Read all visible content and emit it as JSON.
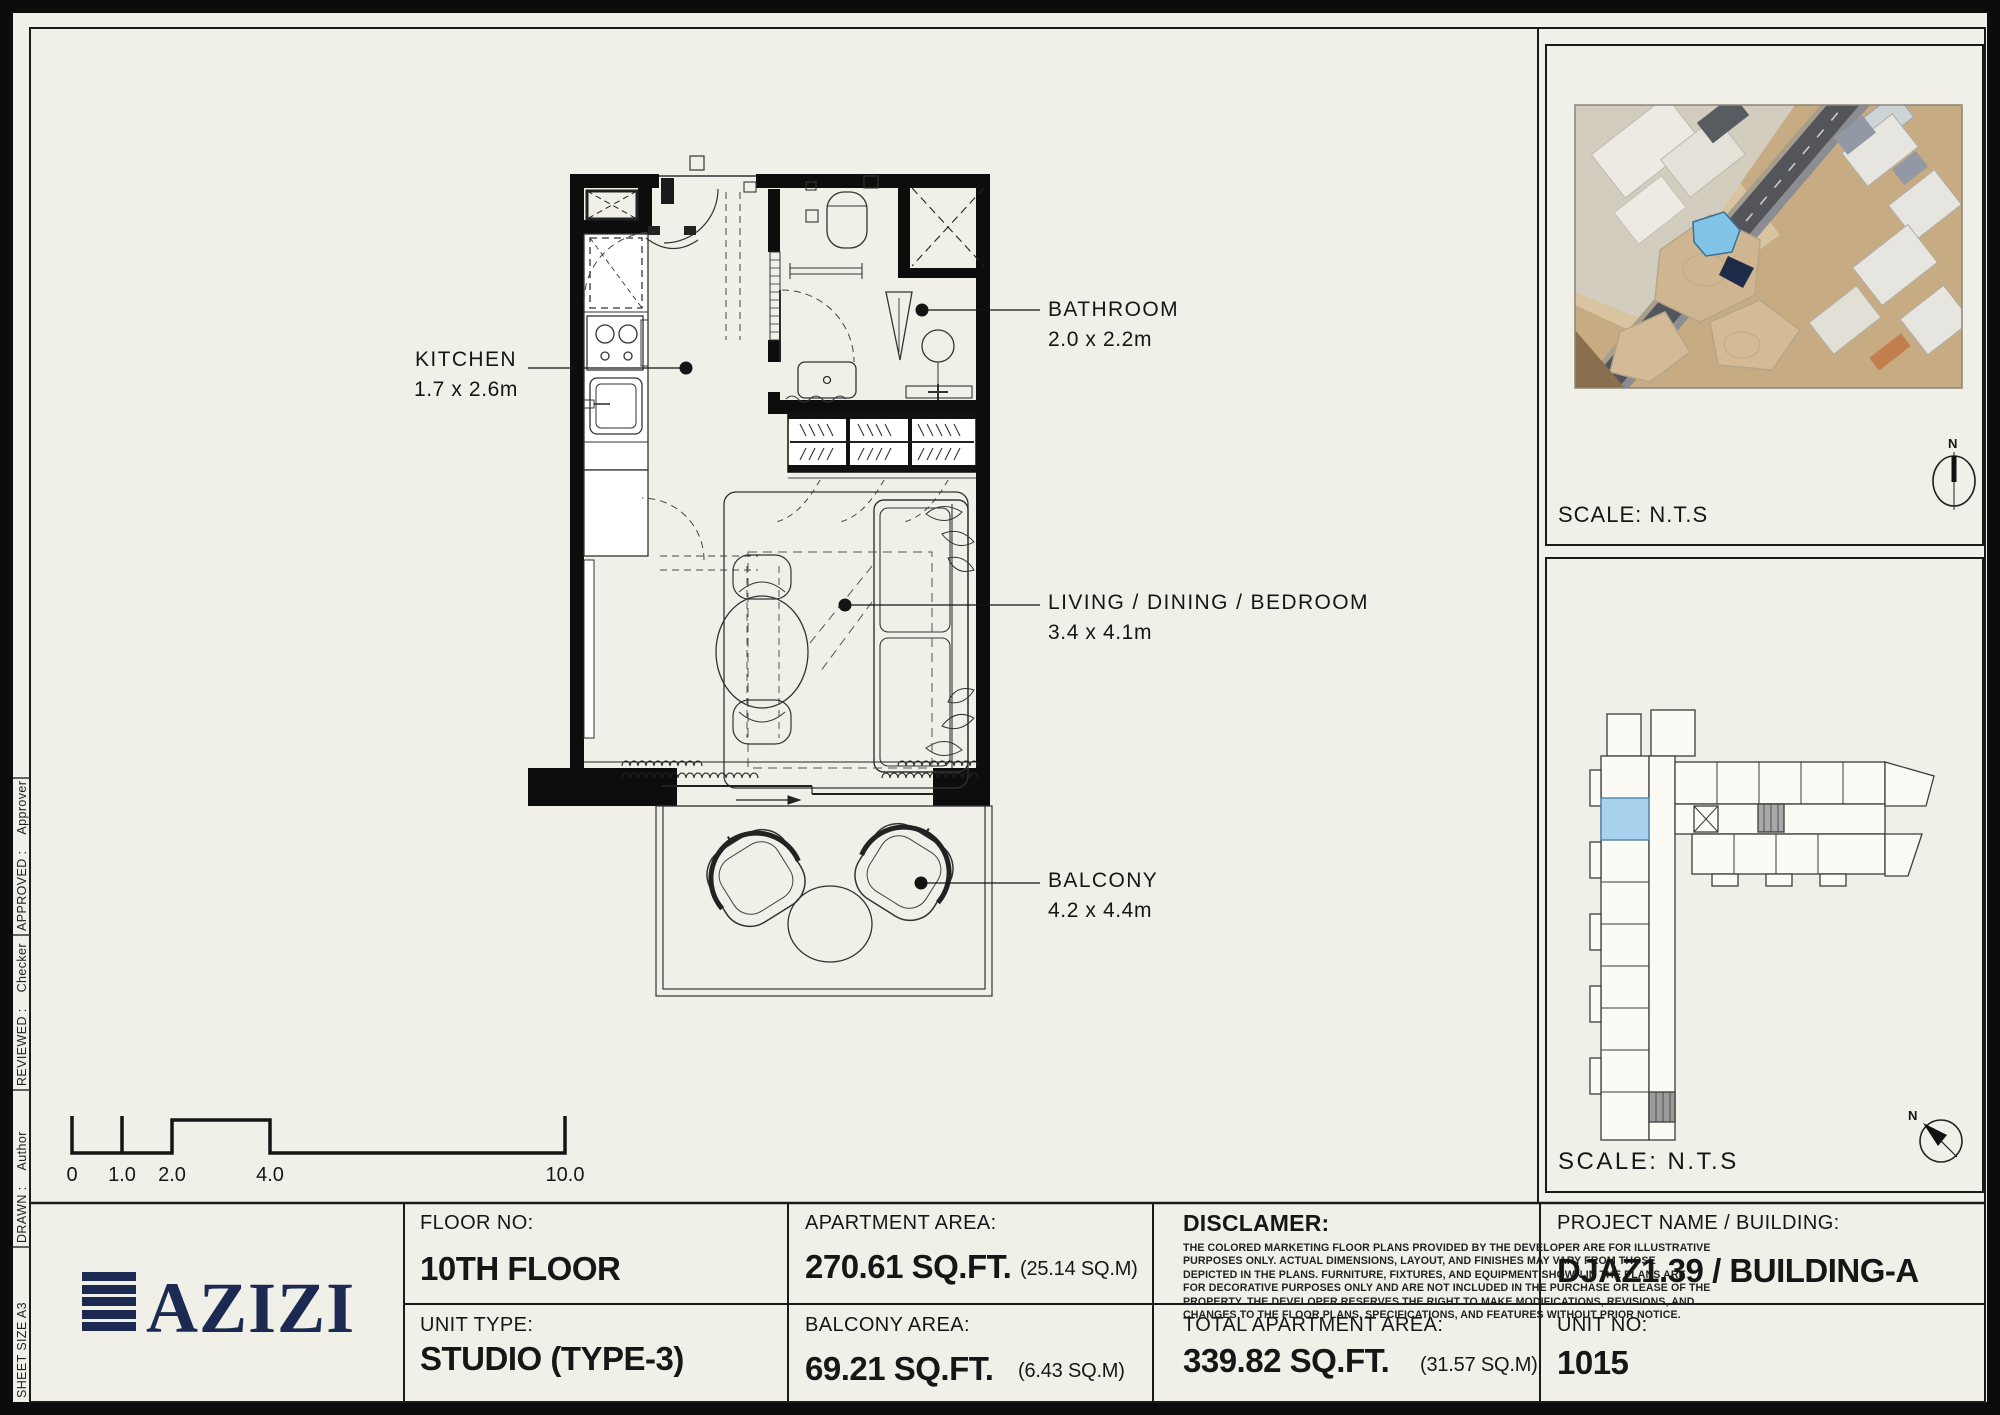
{
  "colors": {
    "background": "#f0efe8",
    "ink": "#111111",
    "brand_navy": "#1c2a52",
    "unit_highlight_blue": "#a9d2ef"
  },
  "plan": {
    "labels": {
      "kitchen": {
        "name": "KITCHEN",
        "dims": "1.7 x 2.6m"
      },
      "bathroom": {
        "name": "BATHROOM",
        "dims": "2.0 x 2.2m"
      },
      "living": {
        "name": "LIVING / DINING / BEDROOM",
        "dims": "3.4 x 4.1m"
      },
      "balcony": {
        "name": "BALCONY",
        "dims": "4.2 x 4.4m"
      }
    },
    "scale_bar": {
      "ticks": [
        "0",
        "1.0",
        "2.0",
        "4.0",
        "10.0"
      ]
    }
  },
  "map_panel": {
    "scale": "SCALE: N.T.S",
    "north": "N"
  },
  "key_panel": {
    "scale": "SCALE: N.T.S",
    "north": "N"
  },
  "side_strip": {
    "sheet_size": "SHEET SIZE A3",
    "drawn_label": "DRAWN :",
    "drawn_value": "Author",
    "reviewed_label": "REVIEWED :",
    "reviewed_value": "Checker",
    "approved_label": "APPROVED :",
    "approved_value": "Approver"
  },
  "title_block": {
    "logo_text": "AZIZI",
    "floor_label": "FLOOR NO:",
    "floor_value": "10TH FLOOR",
    "unit_type_label": "UNIT TYPE:",
    "unit_type_value": "STUDIO (TYPE-3)",
    "apartment_area_label": "APARTMENT AREA:",
    "apartment_area_value": "270.61 SQ.FT.",
    "apartment_area_metric": "(25.14 SQ.M)",
    "balcony_area_label": "BALCONY AREA:",
    "balcony_area_value": "69.21 SQ.FT.",
    "balcony_area_metric": "(6.43 SQ.M)",
    "disclaimer_label": "DISCLAMER:",
    "disclaimer_lines": [
      "THE COLORED MARKETING FLOOR PLANS PROVIDED BY THE DEVELOPER ARE FOR ILLUSTRATIVE",
      "PURPOSES ONLY. ACTUAL DIMENSIONS, LAYOUT, AND FINISHES MAY VARY FROM THOSE",
      "DEPICTED IN THE PLANS. FURNITURE, FIXTURES, AND EQUIPMENT SHOWN IN THE PLANS ARE",
      "FOR DECORATIVE PURPOSES ONLY AND ARE NOT INCLUDED IN THE PURCHASE OR LEASE OF THE",
      "PROPERTY. THE DEVELOPER RESERVES THE RIGHT TO MAKE MODIFICATIONS, REVISIONS, AND",
      "CHANGES TO THE FLOOR PLANS, SPECIFICATIONS, AND FEATURES WITHOUT PRIOR NOTICE."
    ],
    "total_area_label": "TOTAL APARTMENT AREA:",
    "total_area_value": "339.82 SQ.FT.",
    "total_area_metric": "(31.57 SQ.M)",
    "project_label": "PROJECT NAME / BUILDING:",
    "project_value": "DJAZ1.39 / BUILDING-A",
    "unit_no_label": "UNIT NO:",
    "unit_no_value": "1015"
  }
}
